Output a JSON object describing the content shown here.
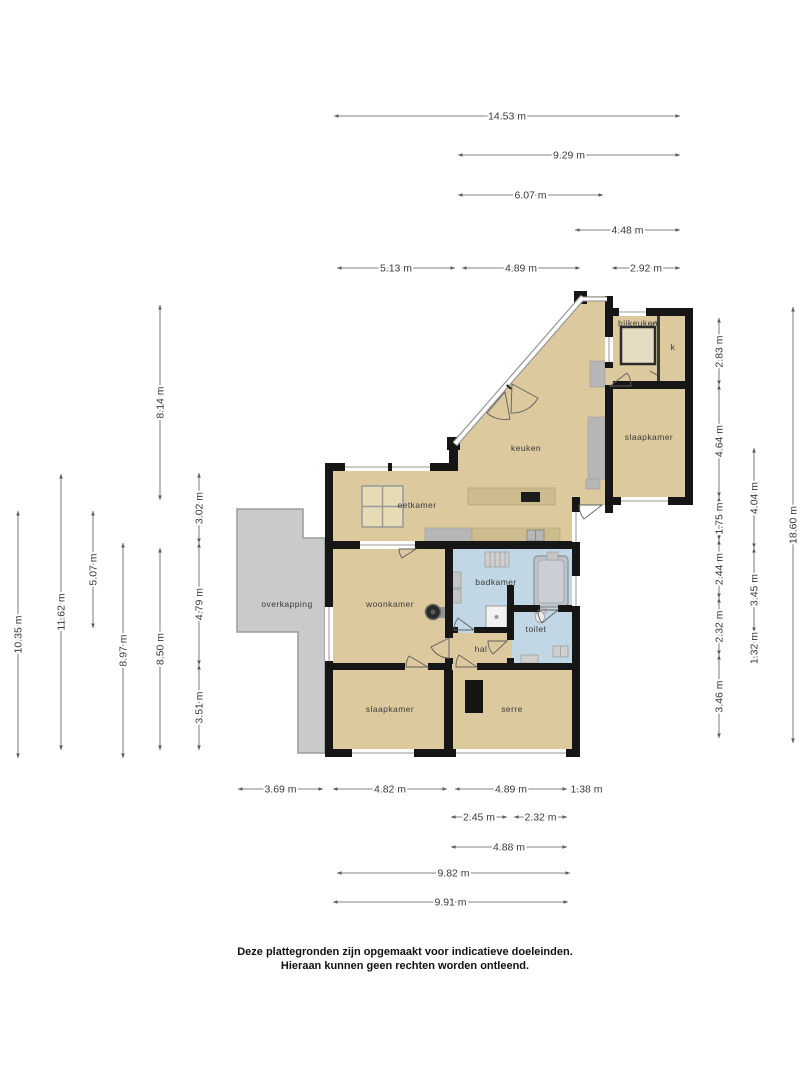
{
  "disclaimer": {
    "line1": "Deze plattegronden zijn opgemaakt voor indicatieve doeleinden.",
    "line2": "Hieraan kunnen geen rechten worden ontleend."
  },
  "colors": {
    "floor": "#dcc99d",
    "wet_room": "#c2d7e5",
    "overkapping": "#cacaca",
    "wall": "#161616",
    "wood_counter": "#cdbc8e",
    "fixture_gray": "#c9c9c9",
    "dimension_text": "#3a3a3a"
  },
  "plan": {
    "room_labels": [
      {
        "id": "bijkeuken",
        "label": "bijkeuken",
        "x": 638,
        "y": 326
      },
      {
        "id": "kast",
        "label": "k",
        "x": 673,
        "y": 350
      },
      {
        "id": "slaapkamer-rechts",
        "label": "slaapkamer",
        "x": 649,
        "y": 440
      },
      {
        "id": "keuken",
        "label": "keuken",
        "x": 526,
        "y": 451
      },
      {
        "id": "eetkamer",
        "label": "eetkamer",
        "x": 417,
        "y": 508
      },
      {
        "id": "overkapping",
        "label": "overkapping",
        "x": 287,
        "y": 607
      },
      {
        "id": "woonkamer",
        "label": "woonkamer",
        "x": 390,
        "y": 607
      },
      {
        "id": "badkamer",
        "label": "badkamer",
        "x": 496,
        "y": 585
      },
      {
        "id": "toilet",
        "label": "toilet",
        "x": 536,
        "y": 632
      },
      {
        "id": "hal",
        "label": "hal",
        "x": 481,
        "y": 652
      },
      {
        "id": "slaapkamer-onder",
        "label": "slaapkamer",
        "x": 390,
        "y": 712
      },
      {
        "id": "serre",
        "label": "serre",
        "x": 512,
        "y": 712
      }
    ],
    "dimensions": [
      {
        "label": "14.53 m",
        "o": "h",
        "x1": 334,
        "x2": 680,
        "y": 116
      },
      {
        "label": "9.29 m",
        "o": "h",
        "x1": 458,
        "x2": 680,
        "y": 155
      },
      {
        "label": "6.07 m",
        "o": "h",
        "x1": 458,
        "x2": 603,
        "y": 195
      },
      {
        "label": "4.48 m",
        "o": "h",
        "x1": 575,
        "x2": 680,
        "y": 230
      },
      {
        "label": "5.13 m",
        "o": "h",
        "x1": 337,
        "x2": 455,
        "y": 268
      },
      {
        "label": "4.89 m",
        "o": "h",
        "x1": 462,
        "x2": 580,
        "y": 268
      },
      {
        "label": "2.92 m",
        "o": "h",
        "x1": 612,
        "x2": 680,
        "y": 268
      },
      {
        "label": "8.14 m",
        "o": "v",
        "x": 160,
        "y1": 305,
        "y2": 500
      },
      {
        "label": "10.35 m",
        "o": "v",
        "x": 18,
        "y1": 511,
        "y2": 758
      },
      {
        "label": "11.62 m",
        "o": "v",
        "x": 61,
        "y1": 474,
        "y2": 750
      },
      {
        "label": "5.07 m",
        "o": "v",
        "x": 93,
        "y1": 511,
        "y2": 628
      },
      {
        "label": "8.97 m",
        "o": "v",
        "x": 123,
        "y1": 543,
        "y2": 758
      },
      {
        "label": "8.50 m",
        "o": "v",
        "x": 160,
        "y1": 548,
        "y2": 750
      },
      {
        "label": "3.02 m",
        "o": "v",
        "x": 199,
        "y1": 473,
        "y2": 543
      },
      {
        "label": "4.79 m",
        "o": "v",
        "x": 199,
        "y1": 543,
        "y2": 665
      },
      {
        "label": "3.51 m",
        "o": "v",
        "x": 199,
        "y1": 665,
        "y2": 750
      },
      {
        "label": "2.83 m",
        "o": "v",
        "x": 719,
        "y1": 318,
        "y2": 385
      },
      {
        "label": "4.64 m",
        "o": "v",
        "x": 719,
        "y1": 385,
        "y2": 497
      },
      {
        "label": "1.75 m",
        "o": "v",
        "x": 719,
        "y1": 497,
        "y2": 540
      },
      {
        "label": "2.44 m",
        "o": "v",
        "x": 719,
        "y1": 540,
        "y2": 598
      },
      {
        "label": "2.32 m",
        "o": "v",
        "x": 719,
        "y1": 598,
        "y2": 655
      },
      {
        "label": "3.46 m",
        "o": "v",
        "x": 719,
        "y1": 655,
        "y2": 738
      },
      {
        "label": "4.04 m",
        "o": "v",
        "x": 754,
        "y1": 448,
        "y2": 548
      },
      {
        "label": "3.45 m",
        "o": "v",
        "x": 754,
        "y1": 548,
        "y2": 632
      },
      {
        "label": "1.32 m",
        "o": "v",
        "x": 754,
        "y1": 632,
        "y2": 664
      },
      {
        "label": "18.60 m",
        "o": "v",
        "x": 793,
        "y1": 307,
        "y2": 743
      },
      {
        "label": "3.69 m",
        "o": "h",
        "x1": 238,
        "x2": 323,
        "y": 789
      },
      {
        "label": "4.82 m",
        "o": "h",
        "x1": 333,
        "x2": 447,
        "y": 789
      },
      {
        "label": "4.89 m",
        "o": "h",
        "x1": 455,
        "x2": 567,
        "y": 789
      },
      {
        "label": "1.38 m",
        "o": "h",
        "x1": 570,
        "x2": 603,
        "y": 789
      },
      {
        "label": "2.45 m",
        "o": "h",
        "x1": 451,
        "x2": 507,
        "y": 817
      },
      {
        "label": "2.32 m",
        "o": "h",
        "x1": 514,
        "x2": 567,
        "y": 817
      },
      {
        "label": "4.88 m",
        "o": "h",
        "x1": 451,
        "x2": 567,
        "y": 847
      },
      {
        "label": "9.82 m",
        "o": "h",
        "x1": 337,
        "x2": 570,
        "y": 873
      },
      {
        "label": "9.91 m",
        "o": "h",
        "x1": 333,
        "x2": 568,
        "y": 902
      }
    ]
  }
}
